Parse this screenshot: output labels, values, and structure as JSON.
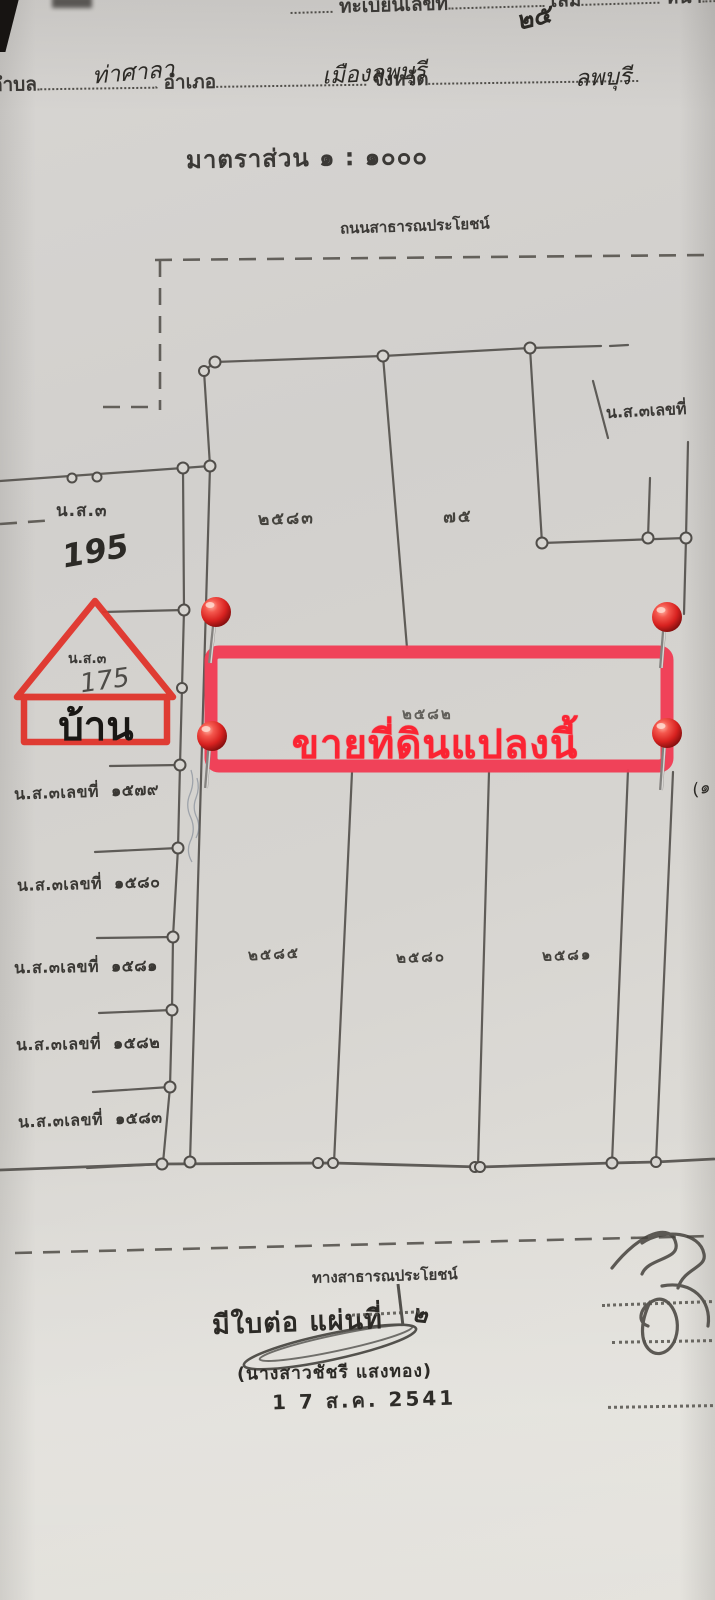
{
  "document": {
    "header": {
      "registry_label": "ทะเบียนเลขที่",
      "volume_label": "เล่ม",
      "volume_value": "๒๕",
      "page_label": "หน้า",
      "subdistrict_label": "ตำบล",
      "subdistrict_value": "ท่าศาลา",
      "district_label": "อำเภอ",
      "district_value": "เมืองลพบุรี",
      "province_label": "จังหวัด",
      "province_value": "ลพบุรี"
    },
    "scale_text": "มาตราส่วน ๑ : ๑๐๐๐",
    "map": {
      "top_road_label": "ถนนสาธารณประโยชน์",
      "bottom_road_label": "ทางสาธารณประโยชน์",
      "ns3_label_upper_left": "น.ส.๓",
      "ns3_number_handwritten": "195",
      "ns3_label_top_right": "น.ส.๓เลขที่",
      "house": {
        "ns3_label": "น.ส.๓",
        "number_handwritten": "175",
        "name": "บ้าน"
      },
      "parcel_labels": {
        "upper_left": "๒๕๘๓",
        "upper_right": "๗๕",
        "highlighted": "๒๕๘๒",
        "bottom_left": "๒๕๘๕",
        "bottom_middle": "๒๕๘๐",
        "bottom_right": "๒๕๘๑"
      },
      "left_parcels": [
        {
          "label": "น.ส.๓เลขที่",
          "number": "๑๕๗๙"
        },
        {
          "label": "น.ส.๓เลขที่",
          "number": "๑๕๘๐"
        },
        {
          "label": "น.ส.๓เลขที่",
          "number": "๑๕๘๑"
        },
        {
          "label": "น.ส.๓เลขที่",
          "number": "๑๕๘๒"
        },
        {
          "label": "น.ส.๓เลขที่",
          "number": "๑๕๘๓"
        }
      ],
      "right_edge_fragment": "(๑",
      "sale_overlay": {
        "text": "ขายที่ดินแปลงนี้",
        "text_color": "#fb2433",
        "box_color": "#f13d55",
        "pin_color": "#d91f1c"
      }
    },
    "footer": {
      "continuation_label": "มีใบต่อ แผ่นที่",
      "continuation_value": "๒",
      "signer_name": "(นางสาวชัชรี  แสงทอง)",
      "date_stamp": "1 7 ส.ค. 2541"
    }
  }
}
